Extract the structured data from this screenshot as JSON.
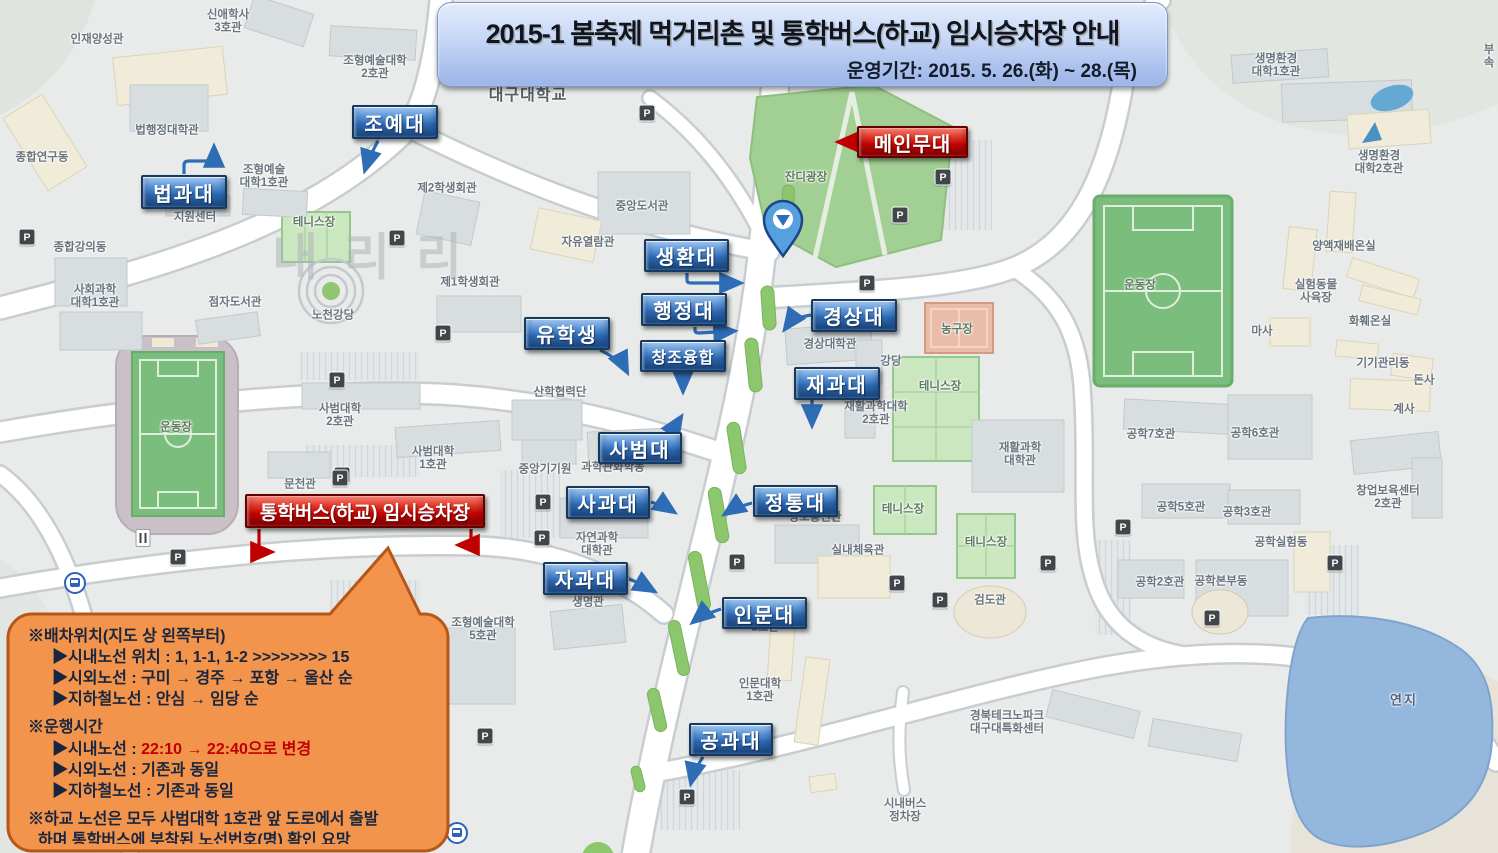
{
  "banner": {
    "title": "2015-1 봄축제 먹거리촌 및 통학버스(하교) 임시승차장 안내",
    "subtitle": "운영기간: 2015. 5. 26.(화) ~ 28.(목)"
  },
  "notice": {
    "sections": [
      {
        "heading": "※배차위치(지도 상 왼쪽부터)",
        "items": [
          {
            "text": "▶시내노선 위치 : 1, 1-1, 1-2 >>>>>>>> 15"
          },
          {
            "text": "▶시외노선 : 구미 → 경주 → 포항 → 울산 순"
          },
          {
            "text": "▶지하철노선 : 안심 → 임당 순"
          }
        ]
      },
      {
        "heading": "※운행시간",
        "items": [
          {
            "prefix": "▶시내노선 : ",
            "red": "22:10 → 22:40으로 변경"
          },
          {
            "text": "▶시외노선 : 기존과 동일"
          },
          {
            "text": "▶지하철노선 : 기존과 동일"
          }
        ]
      },
      {
        "heading": "※하교 노선은 모두 사범대학 1호관 앞 도로에서 출발",
        "items": [
          {
            "text": "하며 통학버스에 부착된 노선번호(명) 확인 요망",
            "indent": "small"
          }
        ]
      }
    ]
  },
  "callouts": [
    {
      "id": "joyedae",
      "text": "조예대",
      "color": "blue",
      "x": 352,
      "y": 105,
      "w": 86,
      "h": 34
    },
    {
      "id": "beopgwadae",
      "text": "법과대",
      "color": "blue",
      "x": 141,
      "y": 175,
      "w": 86,
      "h": 34
    },
    {
      "id": "saenghwandae",
      "text": "생환대",
      "color": "blue",
      "x": 644,
      "y": 239,
      "w": 85,
      "h": 33
    },
    {
      "id": "haengjeongdae",
      "text": "행정대",
      "color": "blue",
      "x": 641,
      "y": 293,
      "w": 86,
      "h": 33
    },
    {
      "id": "yuhaksaeng",
      "text": "유학생",
      "color": "blue",
      "x": 524,
      "y": 317,
      "w": 86,
      "h": 33
    },
    {
      "id": "changjo-yunghap",
      "text": "창조융합",
      "color": "blue",
      "x": 640,
      "y": 340,
      "w": 86,
      "h": 32,
      "variant": "small"
    },
    {
      "id": "gyeongsangdae",
      "text": "경상대",
      "color": "blue",
      "x": 811,
      "y": 299,
      "w": 86,
      "h": 33
    },
    {
      "id": "jaegwadae",
      "text": "재과대",
      "color": "blue",
      "x": 794,
      "y": 367,
      "w": 86,
      "h": 33
    },
    {
      "id": "sabeomdae",
      "text": "사범대",
      "color": "blue",
      "x": 598,
      "y": 432,
      "w": 84,
      "h": 32
    },
    {
      "id": "sagwadae",
      "text": "사과대",
      "color": "blue",
      "x": 566,
      "y": 486,
      "w": 84,
      "h": 33
    },
    {
      "id": "jeongtongdae",
      "text": "정통대",
      "color": "blue",
      "x": 753,
      "y": 485,
      "w": 85,
      "h": 32
    },
    {
      "id": "jagwadae",
      "text": "자과대",
      "color": "blue",
      "x": 543,
      "y": 562,
      "w": 85,
      "h": 33
    },
    {
      "id": "inmundae",
      "text": "인문대",
      "color": "blue",
      "x": 722,
      "y": 597,
      "w": 85,
      "h": 32
    },
    {
      "id": "gonggwadae",
      "text": "공과대",
      "color": "blue",
      "x": 689,
      "y": 723,
      "w": 84,
      "h": 33
    },
    {
      "id": "main-stage",
      "text": "메인무대",
      "color": "red",
      "x": 857,
      "y": 126,
      "w": 111,
      "h": 32
    },
    {
      "id": "shuttle-bus-stop",
      "text": "통학버스(하교) 임시승차장",
      "color": "red",
      "x": 245,
      "y": 494,
      "w": 240,
      "h": 34,
      "variant": "wide"
    }
  ],
  "map_labels": [
    {
      "text": "대구대학교",
      "x": 528,
      "y": 96,
      "cls": "big"
    },
    {
      "text": "인재양성관",
      "x": 97,
      "y": 40
    },
    {
      "text": "신애학사\n3호관",
      "x": 228,
      "y": 22
    },
    {
      "text": "조형예술대학\n2호관",
      "x": 375,
      "y": 68
    },
    {
      "text": "법행정대학관",
      "x": 167,
      "y": 131
    },
    {
      "text": "종합연구동",
      "x": 42,
      "y": 158
    },
    {
      "text": "조형예술\n대학1호관",
      "x": 264,
      "y": 177
    },
    {
      "text": "지원센터",
      "x": 195,
      "y": 218
    },
    {
      "text": "제2학생회관",
      "x": 447,
      "y": 189
    },
    {
      "text": "종합강의동",
      "x": 80,
      "y": 248
    },
    {
      "text": "사회과학\n대학1호관",
      "x": 95,
      "y": 297
    },
    {
      "text": "점자도서관",
      "x": 235,
      "y": 303
    },
    {
      "text": "노천강당",
      "x": 333,
      "y": 316
    },
    {
      "text": "제1학생회관",
      "x": 470,
      "y": 283
    },
    {
      "text": "테니스장",
      "x": 314,
      "y": 223,
      "cls": "green"
    },
    {
      "text": "중앙도서관",
      "x": 642,
      "y": 207
    },
    {
      "text": "자유열람관",
      "x": 588,
      "y": 243
    },
    {
      "text": "잔디광장",
      "x": 806,
      "y": 178,
      "cls": "green"
    },
    {
      "text": "경상대학관",
      "x": 830,
      "y": 345
    },
    {
      "text": "강당",
      "x": 891,
      "y": 362
    },
    {
      "text": "농구장",
      "x": 957,
      "y": 330,
      "cls": "green"
    },
    {
      "text": "테니스장",
      "x": 940,
      "y": 387,
      "cls": "green"
    },
    {
      "text": "재활과학대학\n2호관",
      "x": 876,
      "y": 414
    },
    {
      "text": "재활과학\n대학관",
      "x": 1020,
      "y": 455
    },
    {
      "text": "운동장",
      "x": 1140,
      "y": 286,
      "cls": "green"
    },
    {
      "text": "생명환경\n대학1호관",
      "x": 1276,
      "y": 66
    },
    {
      "text": "생명환경\n대학2호관",
      "x": 1379,
      "y": 163
    },
    {
      "text": "양액재배온실",
      "x": 1344,
      "y": 247
    },
    {
      "text": "실험동물\n사육장",
      "x": 1316,
      "y": 292
    },
    {
      "text": "화훼온실",
      "x": 1370,
      "y": 322
    },
    {
      "text": "마사",
      "x": 1262,
      "y": 332
    },
    {
      "text": "기기관리동",
      "x": 1383,
      "y": 364
    },
    {
      "text": "돈사",
      "x": 1424,
      "y": 381
    },
    {
      "text": "계사",
      "x": 1404,
      "y": 410
    },
    {
      "text": "부속",
      "x": 1489,
      "y": 57
    },
    {
      "text": "사범대학\n2호관",
      "x": 340,
      "y": 416
    },
    {
      "text": "사범대학\n1호관",
      "x": 433,
      "y": 459
    },
    {
      "text": "문천관",
      "x": 300,
      "y": 485
    },
    {
      "text": "운동장",
      "x": 176,
      "y": 428,
      "cls": "green"
    },
    {
      "text": "중앙기기원",
      "x": 545,
      "y": 470
    },
    {
      "text": "산학협력단",
      "x": 560,
      "y": 393
    },
    {
      "text": "과학관화학동",
      "x": 613,
      "y": 468
    },
    {
      "text": "자연과학\n대학관",
      "x": 597,
      "y": 545
    },
    {
      "text": "생명관",
      "x": 588,
      "y": 603
    },
    {
      "text": "정보통신관",
      "x": 815,
      "y": 518
    },
    {
      "text": "실내체육관",
      "x": 858,
      "y": 551
    },
    {
      "text": "검도관",
      "x": 990,
      "y": 601
    },
    {
      "text": "테니스장",
      "x": 903,
      "y": 510,
      "cls": "green"
    },
    {
      "text": "테니스장",
      "x": 986,
      "y": 543,
      "cls": "green"
    },
    {
      "text": "농구장",
      "x": 363,
      "y": 598
    },
    {
      "text": "조형예술대학\n5호관",
      "x": 483,
      "y": 630
    },
    {
      "text": "2호관",
      "x": 765,
      "y": 628
    },
    {
      "text": "인문대학\n1호관",
      "x": 760,
      "y": 691
    },
    {
      "text": "경북테크노파크\n대구대특화센터",
      "x": 1007,
      "y": 723
    },
    {
      "text": "시내버스\n정차장",
      "x": 905,
      "y": 811
    },
    {
      "text": "공학7호관",
      "x": 1151,
      "y": 435
    },
    {
      "text": "공학6호관",
      "x": 1255,
      "y": 434
    },
    {
      "text": "공학5호관",
      "x": 1181,
      "y": 508
    },
    {
      "text": "공학3호관",
      "x": 1247,
      "y": 513
    },
    {
      "text": "공학실험동",
      "x": 1281,
      "y": 543
    },
    {
      "text": "공학2호관",
      "x": 1160,
      "y": 583
    },
    {
      "text": "공학본부동",
      "x": 1221,
      "y": 582
    },
    {
      "text": "창업보육센터\n2호관",
      "x": 1388,
      "y": 498
    },
    {
      "text": "연지",
      "x": 1404,
      "y": 701,
      "cls": "water"
    },
    {
      "text": "내리리",
      "x": 380,
      "y": 258,
      "cls": "watermark"
    }
  ],
  "icons": {
    "parking_glyph": "P",
    "parking_positions": [
      [
        27,
        237
      ],
      [
        397,
        238
      ],
      [
        647,
        113
      ],
      [
        943,
        177
      ],
      [
        900,
        215
      ],
      [
        867,
        283
      ],
      [
        337,
        380
      ],
      [
        443,
        333
      ],
      [
        342,
        475
      ],
      [
        178,
        557
      ],
      [
        340,
        478
      ],
      [
        543,
        502
      ],
      [
        542,
        538
      ],
      [
        737,
        562
      ],
      [
        897,
        583
      ],
      [
        940,
        600
      ],
      [
        1048,
        563
      ],
      [
        1123,
        527
      ],
      [
        1335,
        563
      ],
      [
        1212,
        618
      ],
      [
        687,
        797
      ],
      [
        485,
        736
      ]
    ],
    "transit_positions": [
      [
        75,
        583
      ],
      [
        457,
        833
      ]
    ],
    "restaurant_positions": [
      [
        143,
        538
      ]
    ]
  },
  "colors": {
    "callout_blue": "#2f6cb6",
    "callout_red": "#c70505",
    "arrow_blue": "#2e6cb5",
    "arrow_red": "#c00000",
    "notice_fill": "#f2944b",
    "notice_border": "#b65719",
    "banner_fill": "#c9d9f6"
  }
}
